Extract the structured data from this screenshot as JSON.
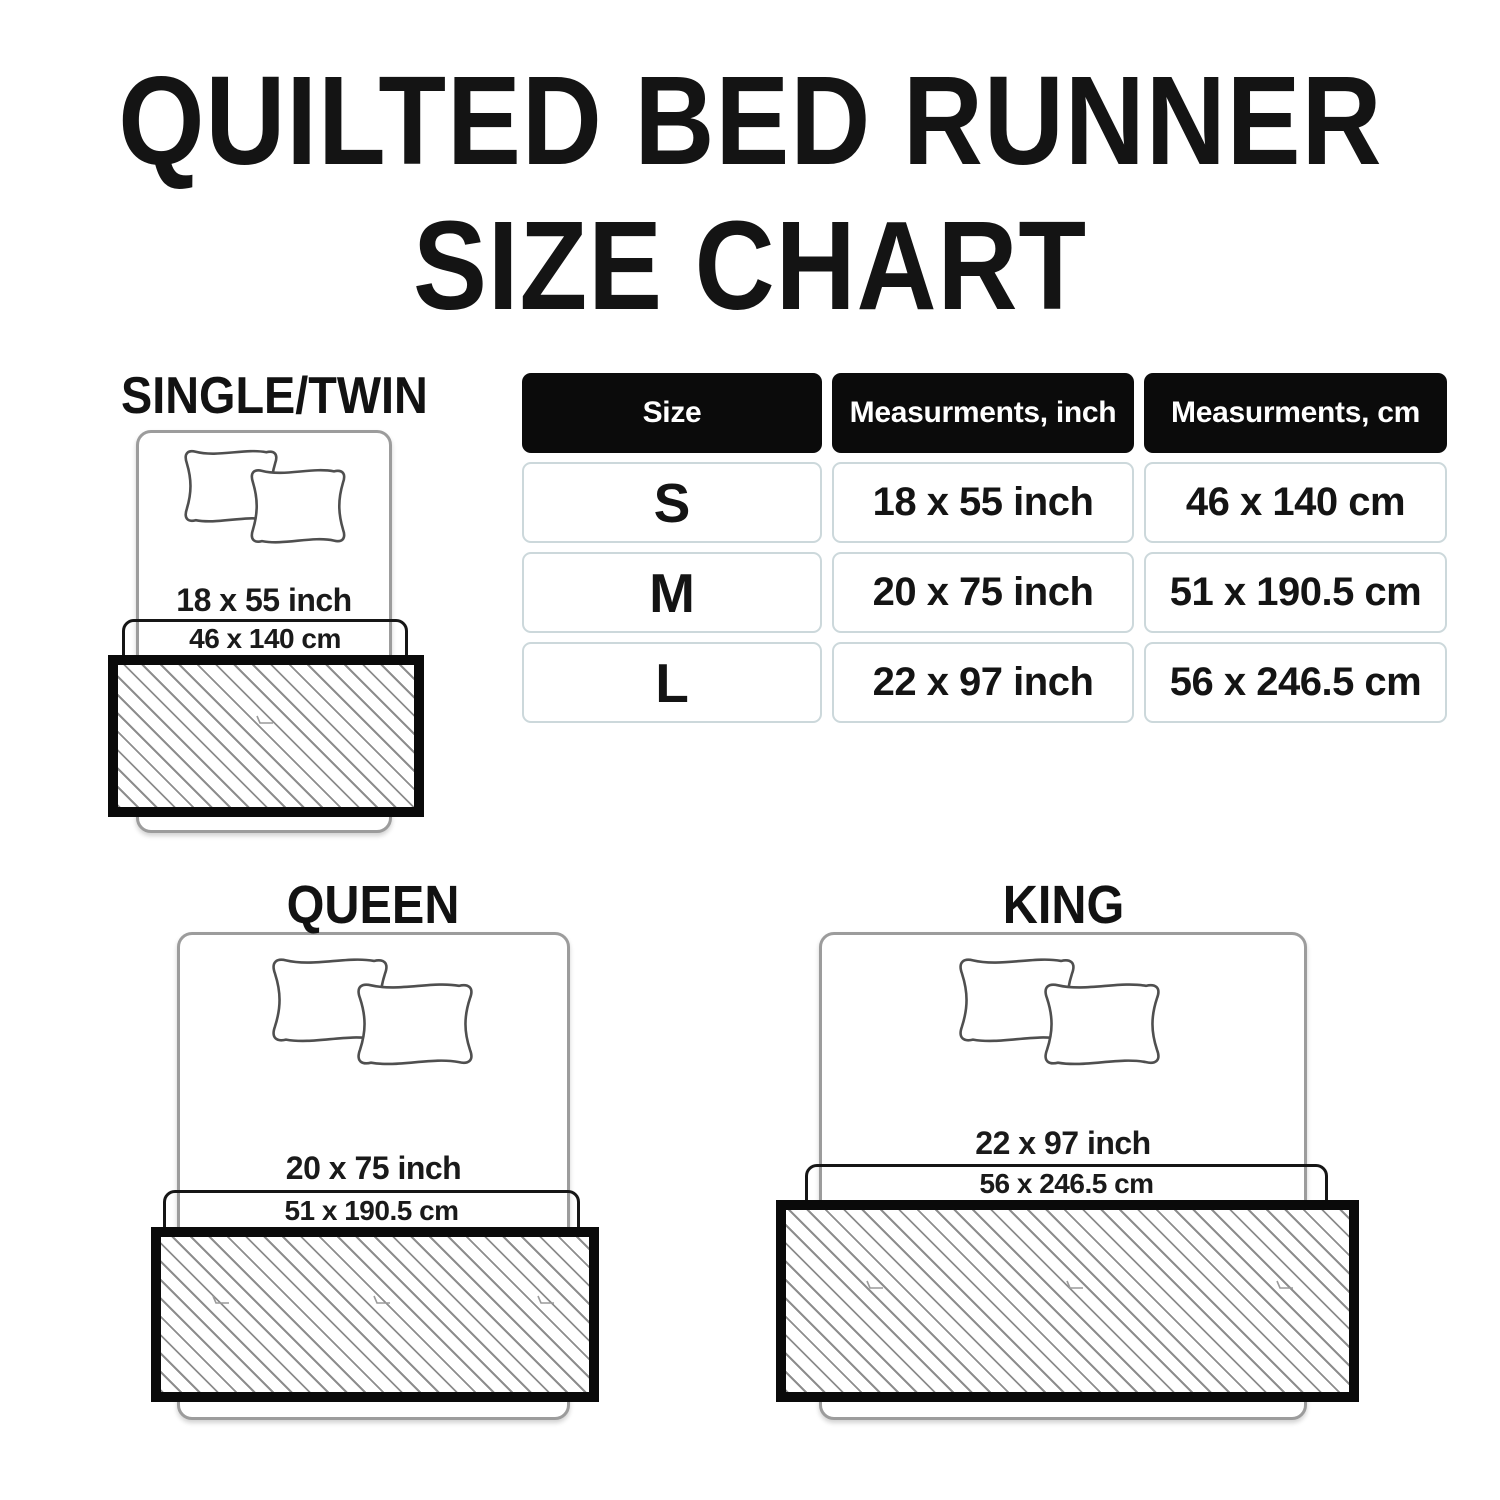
{
  "title": {
    "line1": "QUILTED BED RUNNER",
    "line2": "SIZE CHART"
  },
  "table": {
    "headers": [
      "Size",
      "Measurments, inch",
      "Measurments, cm"
    ],
    "rows": [
      {
        "size": "S",
        "inch": "18 x 55 inch",
        "cm": "46 x 140 cm"
      },
      {
        "size": "M",
        "inch": "20 x 75 inch",
        "cm": "51 x 190.5 cm"
      },
      {
        "size": "L",
        "inch": "22 x 97 inch",
        "cm": "56 x 246.5 cm"
      }
    ]
  },
  "diagrams": [
    {
      "name": "SINGLE/TWIN",
      "inch": "18 x 55 inch",
      "cm": "46 x 140 cm"
    },
    {
      "name": "QUEEN",
      "inch": "20 x 75 inch",
      "cm": "51 x 190.5 cm"
    },
    {
      "name": "KING",
      "inch": "22 x 97 inch",
      "cm": "56 x 246.5 cm"
    }
  ],
  "colors": {
    "background": "#ffffff",
    "text": "#141414",
    "table_header_bg": "#0b0b0b",
    "table_header_text": "#ffffff",
    "table_cell_border": "#ccd8db",
    "bed_outline": "#9c9c9c",
    "pillow_outline": "#4f4f4f",
    "runner_border": "#0a0a0a",
    "hatch_line": "#8d8d8d"
  },
  "chart_data": {
    "type": "table",
    "title": "QUILTED BED RUNNER SIZE CHART",
    "columns": [
      "Size",
      "Measurments, inch",
      "Measurments, cm"
    ],
    "rows": [
      [
        "S",
        "18 x 55 inch",
        "46 x 140 cm"
      ],
      [
        "M",
        "20 x 75 inch",
        "51 x 190.5 cm"
      ],
      [
        "L",
        "22 x 97 inch",
        "56 x 246.5 cm"
      ]
    ]
  }
}
